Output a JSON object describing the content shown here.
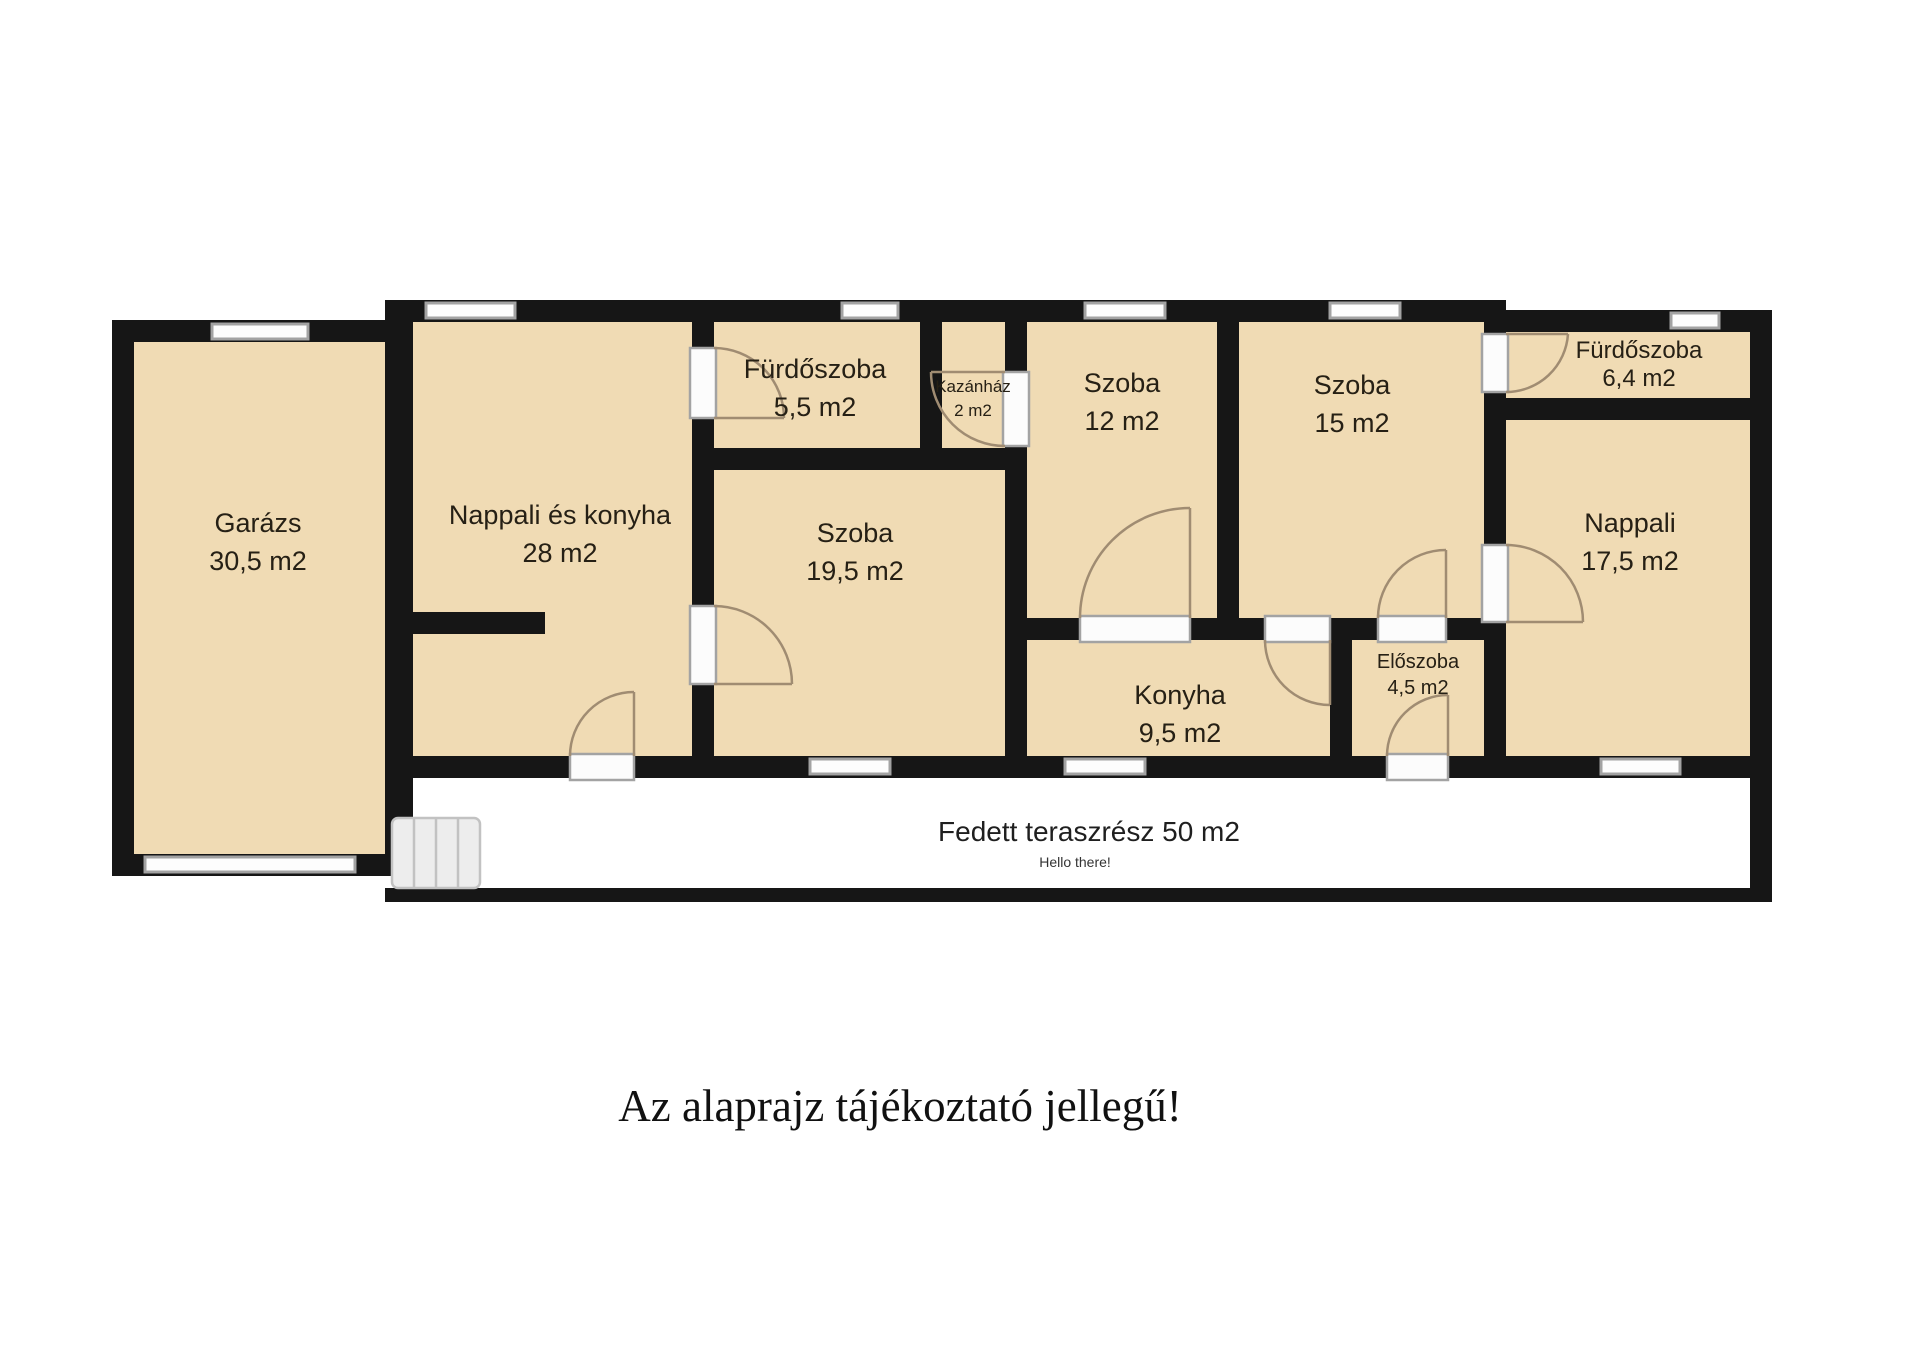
{
  "rooms": [
    {
      "name": "Garázs",
      "area": "30,5 m2"
    },
    {
      "name": "Nappali és konyha",
      "area": "28 m2"
    },
    {
      "name": "Fürdőszoba",
      "area": "5,5 m2"
    },
    {
      "name": "Kazánház",
      "area": "2 m2"
    },
    {
      "name": "Szoba",
      "area": "12 m2"
    },
    {
      "name": "Szoba",
      "area": "15 m2"
    },
    {
      "name": "Fürdőszoba",
      "area": "6,4 m2"
    },
    {
      "name": "Szoba",
      "area": "19,5 m2"
    },
    {
      "name": "Nappali",
      "area": "17,5 m2"
    },
    {
      "name": "Konyha",
      "area": "9,5 m2"
    },
    {
      "name": "Előszoba",
      "area": "4,5 m2"
    }
  ],
  "terrace": {
    "label": "Fedett teraszrész 50 m2",
    "sublabel": "Hello there!"
  },
  "caption": "Az alaprajz tájékoztató jellegű!",
  "colors": {
    "room_fill": "#F0DBB4",
    "wall": "#161616",
    "window_border": "#a3a3a3",
    "door_arc": "#a08c72",
    "stairs_fill": "#ededed"
  }
}
